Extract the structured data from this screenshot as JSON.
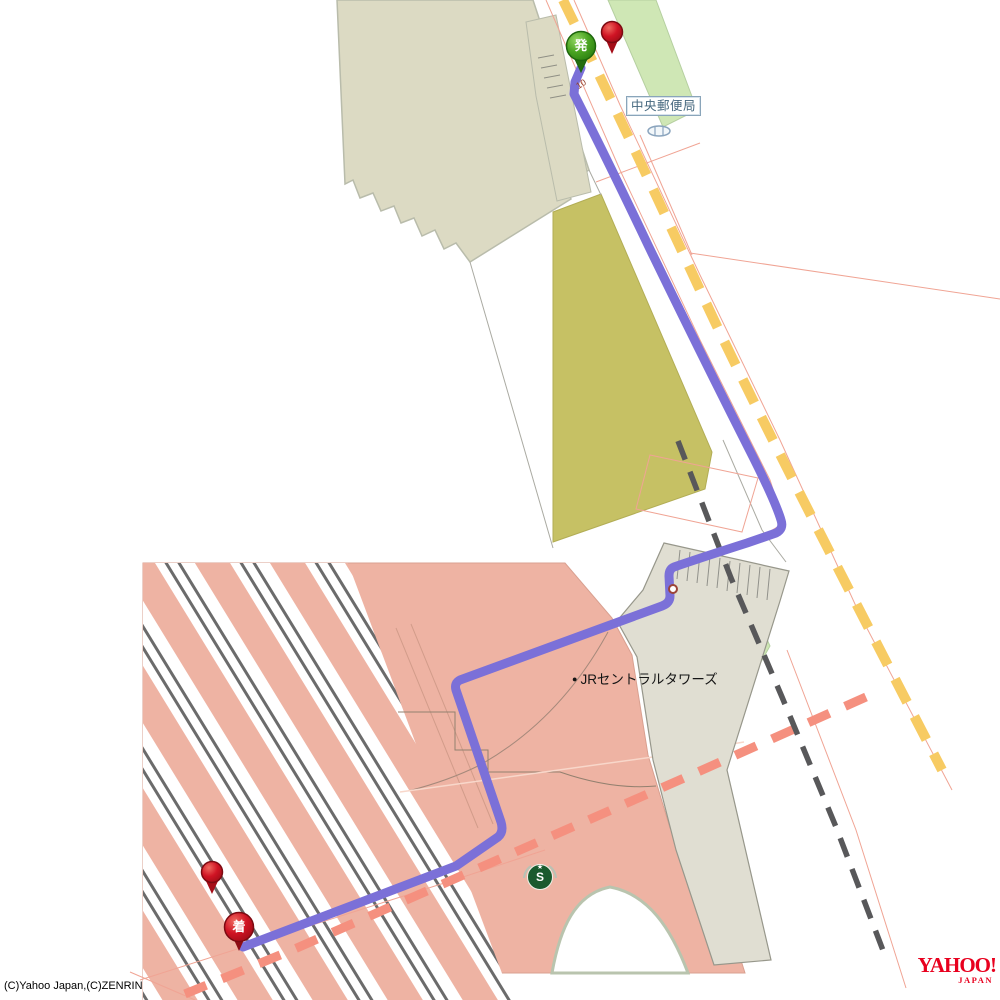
{
  "labels": {
    "post_office": "中央郵便局",
    "jr_towers": "JRセントラルタワーズ",
    "jr_towers_bullet": "●",
    "road_number": "10"
  },
  "markers": {
    "depart_label": "発",
    "arrive_label": "着",
    "starbucks_letter": "S",
    "starbucks_star": "★"
  },
  "footer": {
    "copyright": "(C)Yahoo Japan,(C)ZENRIN"
  },
  "logo": {
    "brand": "YAHOO!",
    "region": "JAPAN"
  },
  "colors": {
    "route_purple": "#7b70d8",
    "road_yellow": "#f7cb63",
    "road_salmon_dash": "#f5907f",
    "railway_dash_gray": "#58585a",
    "station_salmon": "#eeb3a3",
    "building_beige": "#dcdac3",
    "building_olive": "#c6c164",
    "deck_gray": "#e0ded2",
    "green_area": "#cfe7b5",
    "depart_marker_green": "#3f9b1f",
    "arrive_marker_red": "#c41420",
    "starbucks_green": "#1a5a2e",
    "label_border_blue": "#8aa5ba",
    "logo_red": "#e8001e"
  }
}
